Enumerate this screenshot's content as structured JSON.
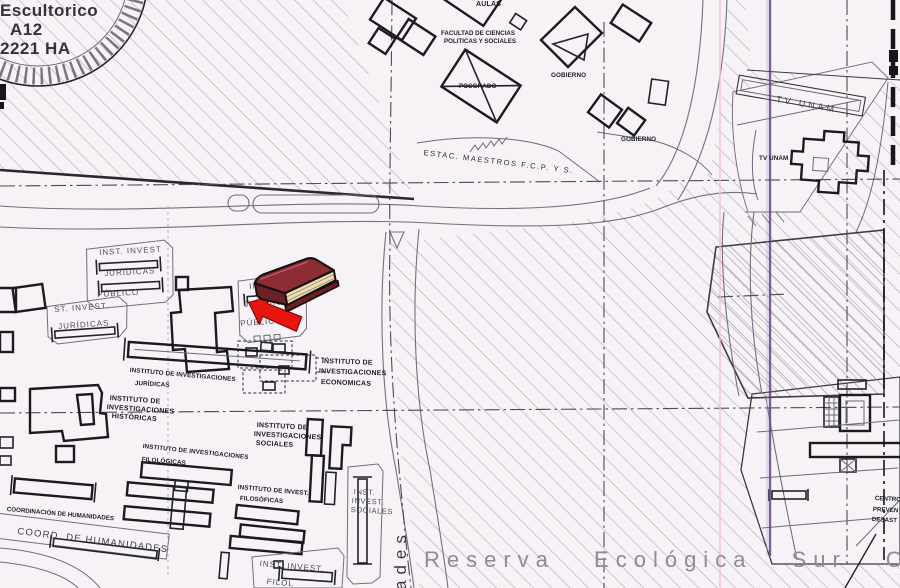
{
  "map": {
    "title_context": "scanned campus plan, UNAM Ciudad Universitaria south zone",
    "labels": {
      "stamp1": "Escultorico",
      "stamp2": "A12",
      "stamp3": "2221 HA",
      "aulas": "AULAS",
      "fcpys1": "FACULTAD DE CIENCIAS",
      "fcpys2": "POLITICAS Y SOCIALES",
      "gobierno_1": "GOBIERNO",
      "posgrado": "POSGRADO",
      "gobierno_2": "GOBIERNO",
      "estac": "ESTAC. MAESTROS F.C.P. Y S.",
      "tvunam_street": "TV UNAM",
      "tvunam": "TV UNAM",
      "lot1_1": "INST. INVEST",
      "lot1_2": "JURIDICAS",
      "lot1_3": "PÚBLICO",
      "lot2_1": "ST. INVEST.",
      "lot2_2": "JURÍDICAS",
      "lot3_1": "INST.",
      "lot3_2": "JURÍDICAS",
      "lot3_3": "PÚBLICO",
      "econ1": "INSTITUTO DE",
      "econ2": "INVESTIGACIONES",
      "econ3": "ECONOMICAS",
      "jur1": "INSTITUTO DE INVESTIGACIONES",
      "jur2": "JURÍDICAS",
      "hist1": "INSTITUTO DE",
      "hist2": "INVESTIGACIONES",
      "hist3": "HISTÓRICAS",
      "soc1": "INSTITUTO DE",
      "soc2": "INVESTIGACIONES",
      "soc3": "SOCIALES",
      "filolog1": "INSTITUTO DE INVESTIGACIONES",
      "filolog2": "FILOLÓGICAS",
      "filosof1": "INSTITUTO DE INVEST.",
      "filosof2": "FILOSÓFICAS",
      "coordinacion": "COORDINACIÓN DE HUMANIDADES",
      "coord_strip": "COORD. DE HUMANIDADES",
      "socsm1": "INST.",
      "socsm2": "INVEST.",
      "socsm3": "SOCIALES",
      "filsm1": "INST. INVEST.",
      "filsm2": "FILOL",
      "street_v": "ades",
      "reserva": "Reserva Ecológica Sur Or",
      "cen1": "CENTRO",
      "cen2": "PREVEN",
      "cen3": "DESAST"
    },
    "icons": {
      "book": "book-icon",
      "cursor": "red-arrow-cursor"
    },
    "colors": {
      "paper": "#f6f2f6",
      "book_cover": "#8c2d36",
      "book_pages": "#ece0b8",
      "cursor_red": "#e8140e",
      "scan_line_purple": "#64448e",
      "scan_line_pink": "#edc3de"
    }
  }
}
